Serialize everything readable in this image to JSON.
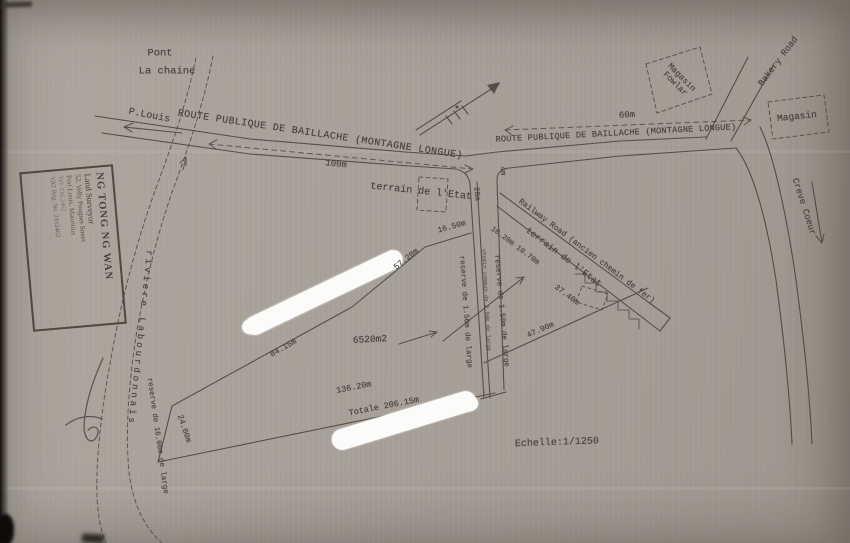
{
  "labels": {
    "pont": "Pont",
    "la_chaine": "La chaine",
    "p_louis": "P.Louis",
    "route_1": "ROUTE PUBLIQUE DE BAILLACHE (MONTAGNE LONGUE)",
    "route_2": "ROUTE PUBLIQUE DE BAILLACHE (MONTAGNE LONGUE)",
    "magasin_fowlar_1": "Magasin",
    "magasin_fowlar_2": "Fowlar",
    "bakery_road": "Bakery Road",
    "magasin": "Magasin",
    "creve_coeur": "Creve Coeur",
    "terrain_etat_nw": "terrain de l'Etat",
    "terrain_etat_se": "terrain de l'Etat",
    "railway_road": "Railway Road (ancien chemin de fer)",
    "riviere": "riviere Labourdonnais",
    "reserve_riviere": "reserve de 16.00m de large",
    "reserve_chemin_left": "reserve de 1.50m de large",
    "reserve_chemin_right": "reserve de 1.50m de large",
    "chemin_commun": "chemin commun de 2.50m de large",
    "area": "6520m2",
    "echelle": "Echelle:1/1250"
  },
  "measurements": {
    "d100": "100m",
    "d60": "60m",
    "d28": "28m",
    "d4": "4m",
    "d16_50": "16.50m",
    "d57_20": "57.20m",
    "d10_20": "10.20m 10.70m",
    "d37_40": "37.40m",
    "d47_90": "47.90m",
    "d84_15": "84.15m",
    "d136_20": "136.20m",
    "totale": "Totale 206.15m",
    "d24": "24.00m"
  },
  "stamp": {
    "name": "NG TONG NG WAN",
    "title": "Land Surveyor",
    "address1": "52, Velly Pougnet Street",
    "address2": "Port Louis, Mauritius",
    "phone": "Tel: 216 2462",
    "vat": "VAT Reg. No. 2162462"
  },
  "colors": {
    "paper": "#a7a199",
    "ink": "#46403a",
    "white_out": "#fbfbfa"
  }
}
